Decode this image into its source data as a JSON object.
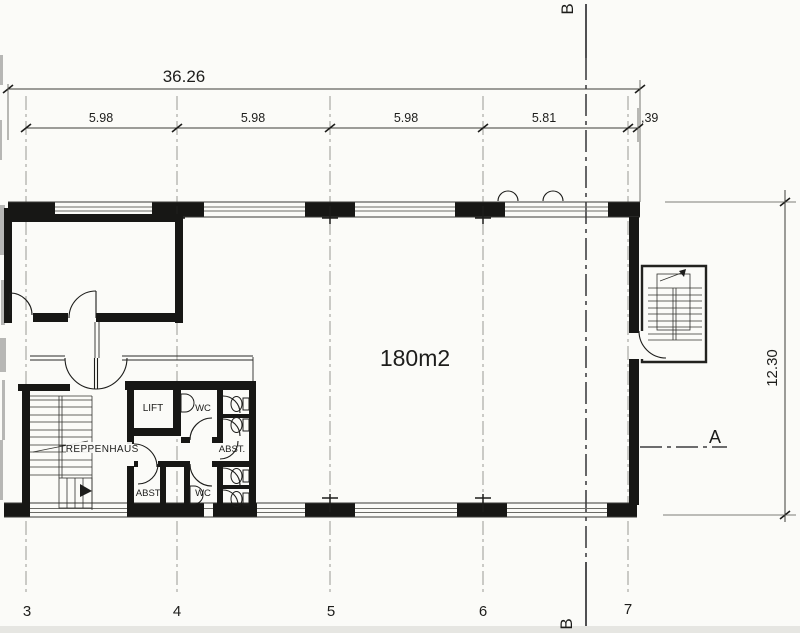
{
  "plan": {
    "area_label": "180m2",
    "rooms": {
      "treppenhaus": "TREPPENHAUS",
      "lift": "LIFT",
      "wc_top": "WC",
      "wc_bottom": "WC",
      "abst_mid": "ABST.",
      "abst_left": "ABST."
    },
    "dimensions": {
      "total_width": "36.26",
      "bays": [
        "5.98",
        "5.98",
        "5.98",
        "5.81",
        ",39"
      ],
      "right_height": "12.30"
    },
    "grid_labels": [
      "3",
      "4",
      "5",
      "6",
      "7"
    ],
    "sections": {
      "a": "A",
      "b_top": "B",
      "b_bottom": "B"
    }
  },
  "colors": {
    "ink": "#1d1d1b",
    "paper": "#fbfbf8",
    "wall": "#171715",
    "window_line": "#6b6b66"
  }
}
